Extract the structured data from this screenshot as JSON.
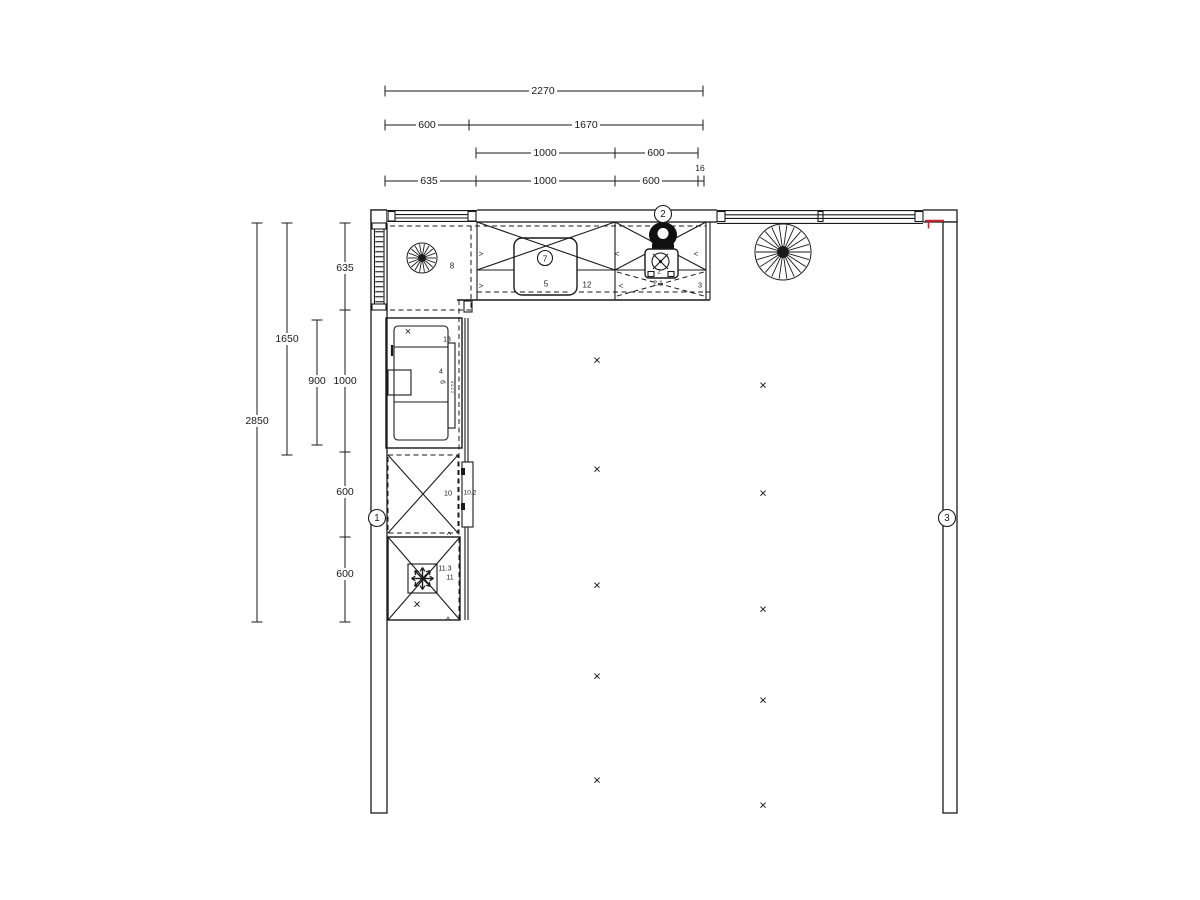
{
  "plan": {
    "type": "kitchen-floor-plan",
    "colors": {
      "line": "#1a1a1a",
      "red": "#c1272d",
      "bg": "#ffffff"
    }
  },
  "dim_chains": [
    {
      "orient": "h",
      "y": 91,
      "ticks": [
        385,
        703
      ],
      "labels": [
        {
          "t": "2270",
          "x": 543
        }
      ]
    },
    {
      "orient": "h",
      "y": 125,
      "ticks": [
        385,
        469,
        703
      ],
      "labels": [
        {
          "t": "600",
          "x": 427
        },
        {
          "t": "1670",
          "x": 586
        }
      ]
    },
    {
      "orient": "h",
      "y": 153,
      "ticks": [
        476,
        615,
        698
      ],
      "labels": [
        {
          "t": "1000",
          "x": 545
        },
        {
          "t": "600",
          "x": 656
        }
      ]
    },
    {
      "orient": "h",
      "y": 181,
      "ticks": [
        385,
        476,
        615,
        698,
        704
      ],
      "labels": [
        {
          "t": "635",
          "x": 429
        },
        {
          "t": "1000",
          "x": 545
        },
        {
          "t": "600",
          "x": 651
        }
      ]
    },
    {
      "orient": "v",
      "x": 257,
      "ticks": [
        223,
        622
      ],
      "labels": [
        {
          "t": "2850",
          "y": 421
        }
      ]
    },
    {
      "orient": "v",
      "x": 287,
      "ticks": [
        223,
        455
      ],
      "labels": [
        {
          "t": "1650",
          "y": 339
        }
      ]
    },
    {
      "orient": "v",
      "x": 317,
      "ticks": [
        320,
        445
      ],
      "labels": [
        {
          "t": "900",
          "y": 381
        }
      ]
    },
    {
      "orient": "v",
      "x": 345,
      "ticks": [
        223,
        310,
        452,
        537,
        622
      ],
      "labels": [
        {
          "t": "635",
          "y": 268
        },
        {
          "t": "1000",
          "y": 381
        },
        {
          "t": "600",
          "y": 492
        },
        {
          "t": "600",
          "y": 574
        }
      ]
    }
  ],
  "free_labels": [
    {
      "t": "16",
      "x": 700,
      "y": 168,
      "s": 8.5
    },
    {
      "t": "8",
      "x": 452,
      "y": 266,
      "s": 8
    },
    {
      "t": "5",
      "x": 546,
      "y": 284,
      "s": 8
    },
    {
      "t": "12",
      "x": 587,
      "y": 285,
      "s": 8
    },
    {
      "t": "2",
      "x": 659,
      "y": 272,
      "s": 6.5
    },
    {
      "t": "2.1",
      "x": 658,
      "y": 284,
      "s": 7
    },
    {
      "t": "3",
      "x": 700,
      "y": 285,
      "s": 7.5
    },
    {
      "t": "13",
      "x": 447,
      "y": 340,
      "s": 7
    },
    {
      "t": "4",
      "x": 441,
      "y": 372,
      "s": 7
    },
    {
      "t": "9",
      "x": 444,
      "y": 382,
      "s": 7,
      "rot": -90
    },
    {
      "t": "2.5 6.6",
      "x": 452,
      "y": 387,
      "s": 4,
      "rot": -90
    },
    {
      "t": "10",
      "x": 448,
      "y": 493,
      "s": 7.5
    },
    {
      "t": "10.2",
      "x": 470,
      "y": 493,
      "s": 6.5
    },
    {
      "t": "11.3",
      "x": 445,
      "y": 569,
      "s": 7
    },
    {
      "t": "11",
      "x": 450,
      "y": 578,
      "s": 7
    },
    {
      "t": "^",
      "x": 449,
      "y": 535,
      "s": 9
    },
    {
      "t": "^",
      "x": 448,
      "y": 620,
      "s": 9
    },
    {
      "t": ">",
      "x": 481,
      "y": 254,
      "s": 8
    },
    {
      "t": ">",
      "x": 481,
      "y": 286,
      "s": 8
    },
    {
      "t": "<",
      "x": 617,
      "y": 254,
      "s": 8
    },
    {
      "t": "<",
      "x": 621,
      "y": 286,
      "s": 8
    },
    {
      "t": "<",
      "x": 696,
      "y": 254,
      "s": 8
    }
  ],
  "circled_markers": [
    {
      "t": "1",
      "x": 377,
      "y": 518,
      "r": 8.5
    },
    {
      "t": "2",
      "x": 663,
      "y": 214,
      "r": 8.5
    },
    {
      "t": "3",
      "x": 947,
      "y": 518,
      "r": 8.5
    },
    {
      "t": "7",
      "x": 545,
      "y": 258,
      "r": 7.5
    }
  ],
  "cabinet_x_marks": [
    {
      "x": 408,
      "y": 332,
      "s": 11
    },
    {
      "x": 417,
      "y": 604,
      "s": 13
    }
  ],
  "ceiling_lights": [
    {
      "x": 597,
      "y": 360
    },
    {
      "x": 763,
      "y": 385
    },
    {
      "x": 597,
      "y": 469
    },
    {
      "x": 763,
      "y": 493
    },
    {
      "x": 597,
      "y": 585
    },
    {
      "x": 763,
      "y": 609
    },
    {
      "x": 597,
      "y": 676
    },
    {
      "x": 763,
      "y": 700
    },
    {
      "x": 597,
      "y": 780
    },
    {
      "x": 763,
      "y": 805
    }
  ],
  "fans": [
    {
      "cx": 422,
      "cy": 258,
      "r": 15,
      "hub": 4,
      "spokes": 18
    },
    {
      "cx": 783,
      "cy": 252,
      "r": 28,
      "hub": 6,
      "spokes": 22
    }
  ],
  "symbols": {
    "snowflake": {
      "cx": 422.5,
      "cy": 578.5,
      "r": 11
    }
  }
}
